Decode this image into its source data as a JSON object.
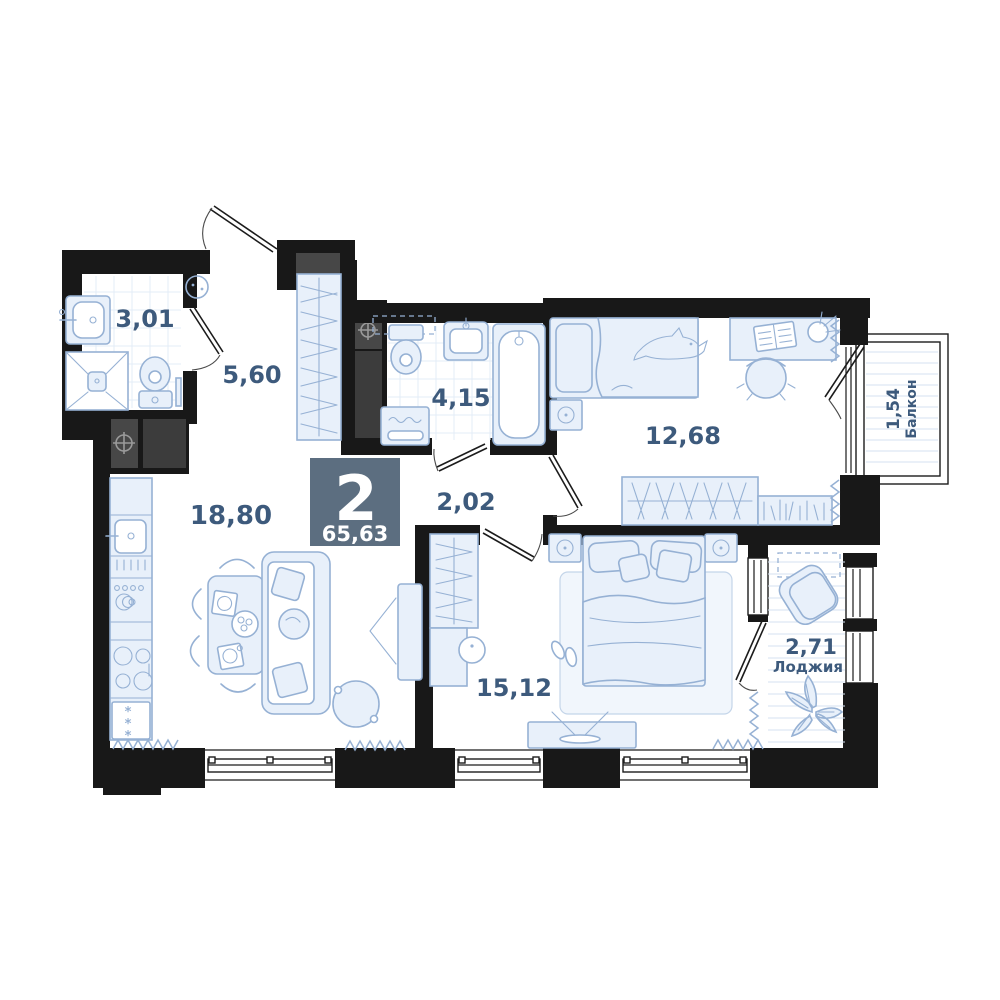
{
  "badge": {
    "rooms_count": "2",
    "total_area": "65,63"
  },
  "rooms": {
    "wc_small": {
      "area": "3,01"
    },
    "hallway": {
      "area": "5,60"
    },
    "bathroom": {
      "area": "4,15"
    },
    "hall": {
      "area": "2,02"
    },
    "kitchen_living": {
      "area": "18,80"
    },
    "bedroom_small": {
      "area": "12,68"
    },
    "bedroom_master": {
      "area": "15,12"
    },
    "loggia": {
      "area": "2,71",
      "label": "Лоджия"
    },
    "balcony": {
      "area": "1,54",
      "label": "Балкон"
    }
  },
  "colors": {
    "wall": "#181818",
    "furniture_stroke": "#96b1d4",
    "furniture_fill": "#e8f0fa",
    "label_text": "#3d5a7c",
    "badge_bg": "#5c6e80",
    "badge_text": "#ffffff"
  }
}
